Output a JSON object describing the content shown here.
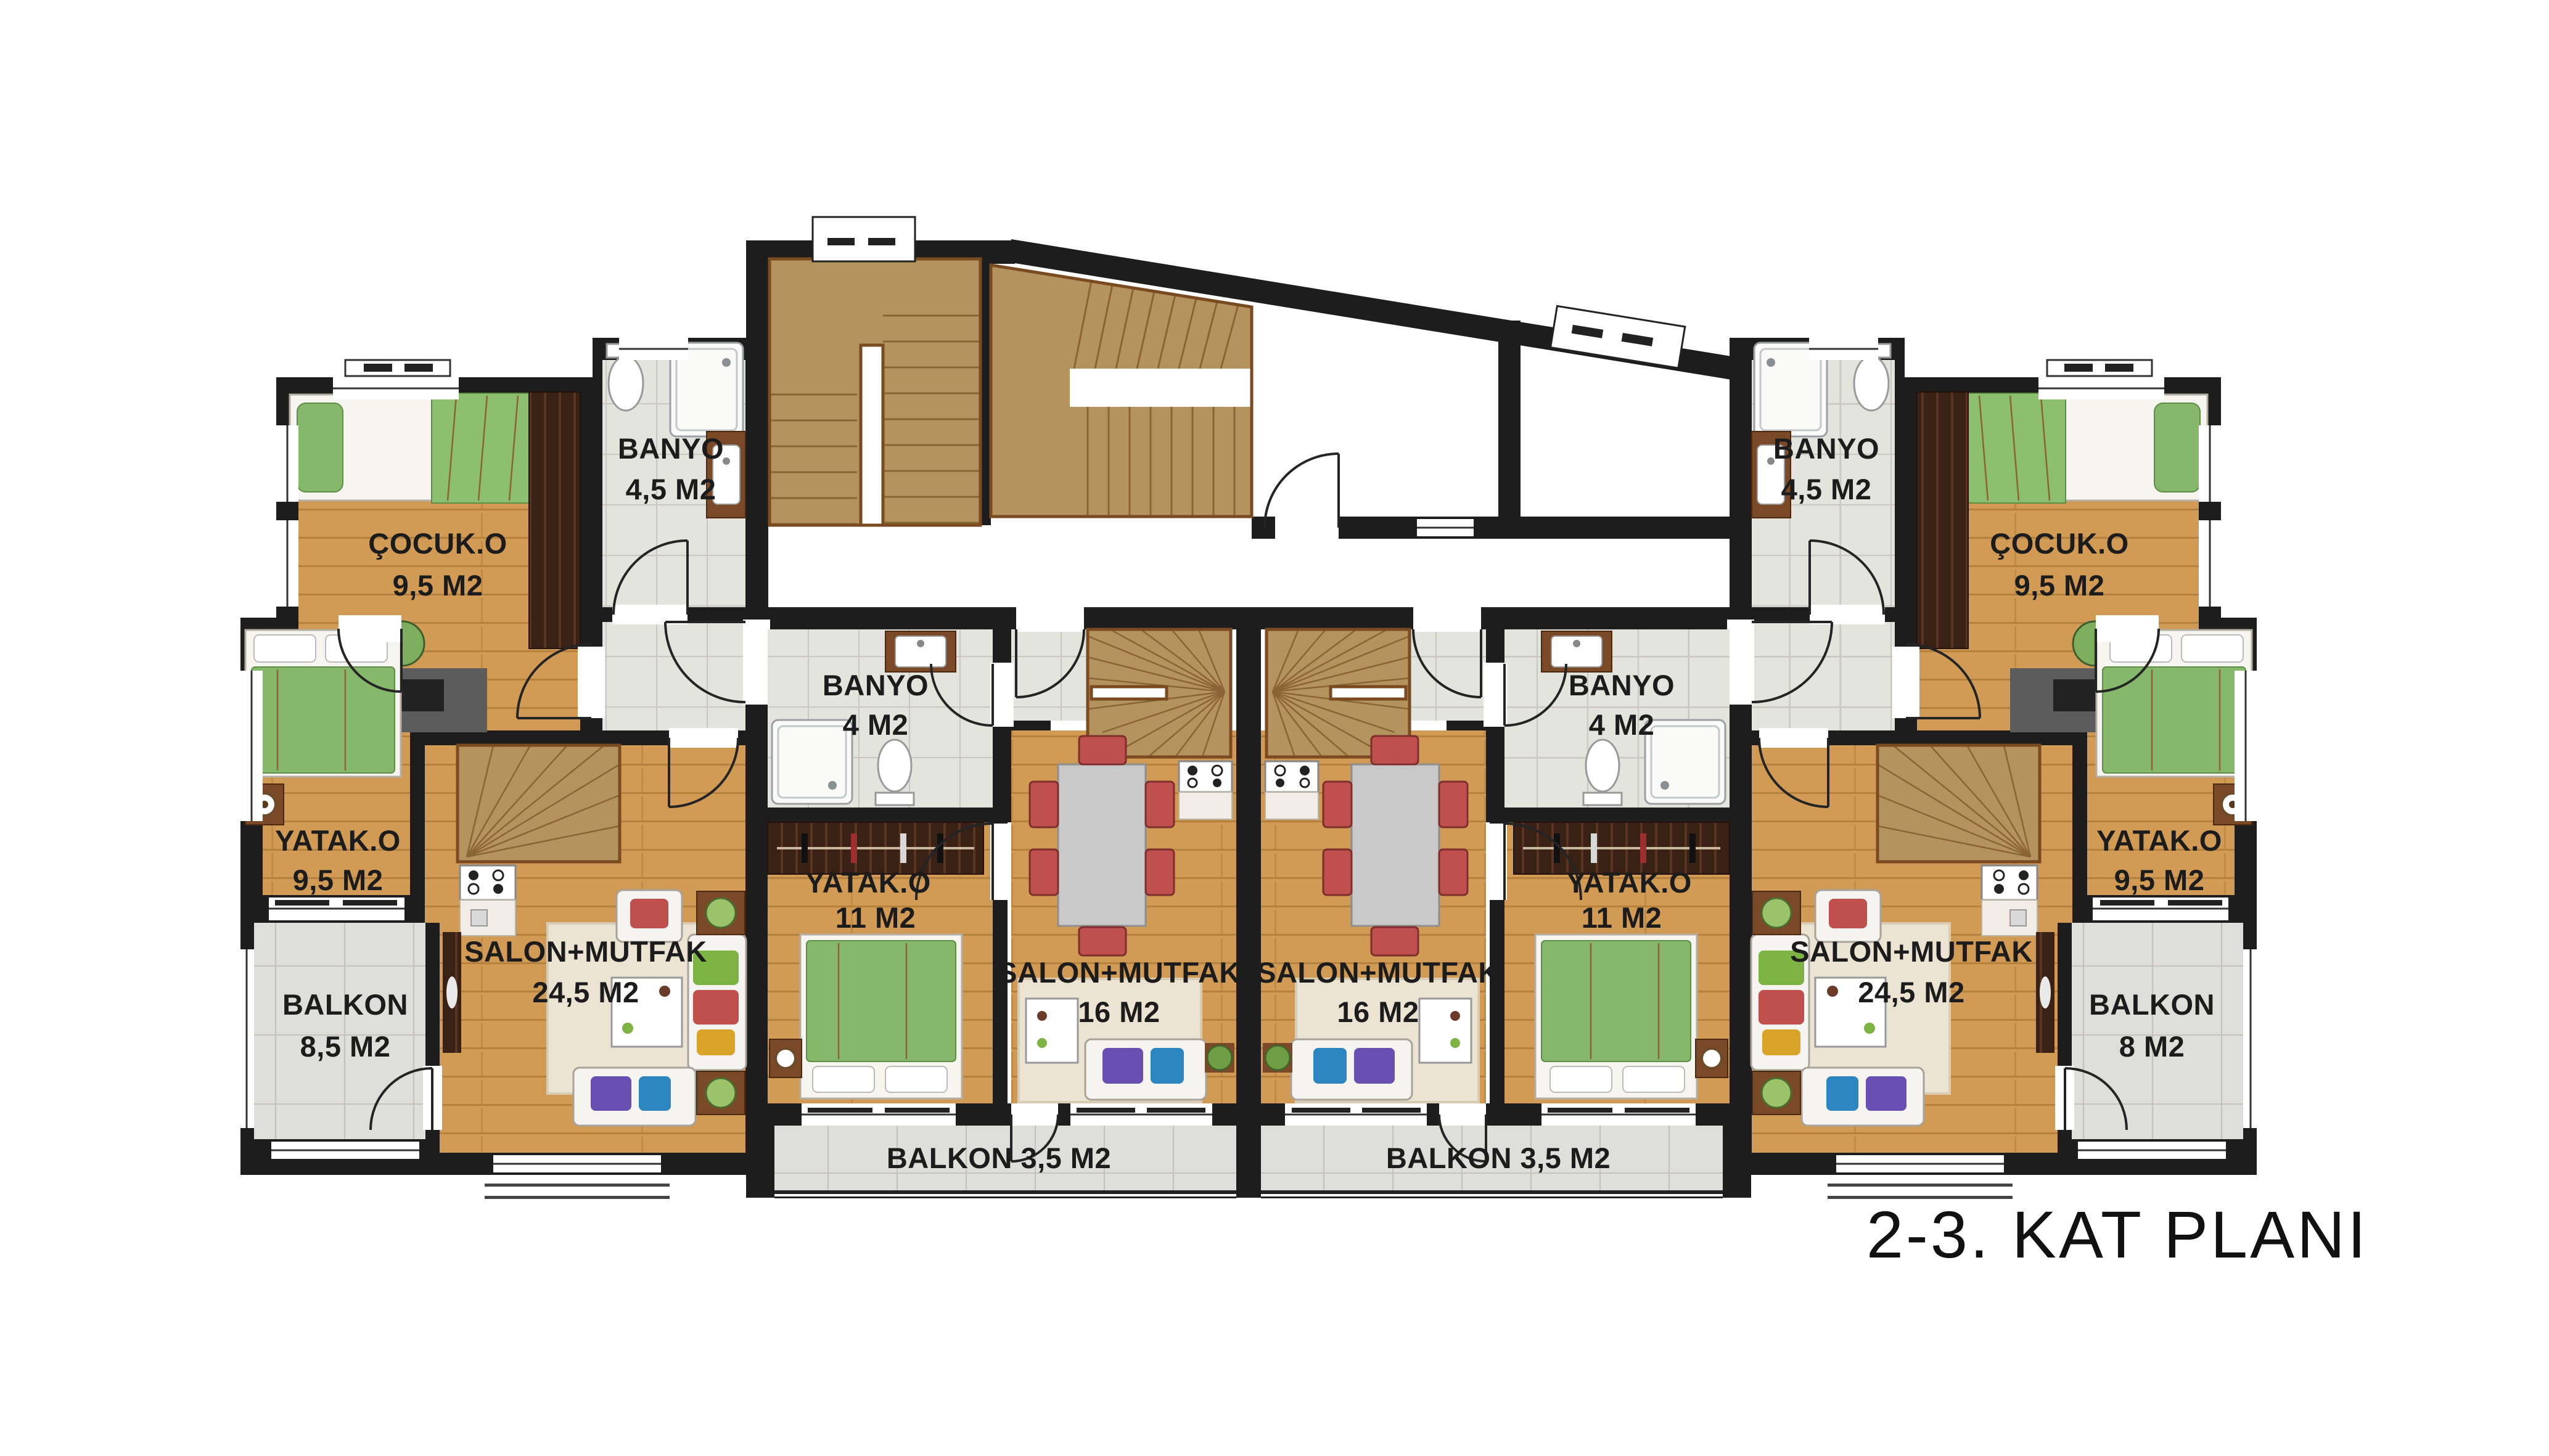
{
  "title": "2-3. KAT PLANI",
  "apartments": {
    "left": {
      "cocuk": {
        "name": "ÇOCUK.O",
        "area": "9,5 M2"
      },
      "banyo": {
        "name": "BANYO",
        "area": "4,5 M2"
      },
      "yatak": {
        "name": "YATAK.O",
        "area": "9,5 M2"
      },
      "balkon": {
        "name": "BALKON",
        "area": "8,5 M2"
      },
      "salon": {
        "name": "SALON+MUTFAK",
        "area": "24,5 M2"
      }
    },
    "center_left": {
      "banyo": {
        "name": "BANYO",
        "area": "4 M2"
      },
      "yatak": {
        "name": "YATAK.O",
        "area": "11 M2"
      },
      "salon": {
        "name": "SALON+MUTFAK",
        "area": "16 M2"
      },
      "balkon": {
        "name": "BALKON 3,5 M2"
      }
    },
    "center_right": {
      "banyo": {
        "name": "BANYO",
        "area": "4 M2"
      },
      "yatak": {
        "name": "YATAK.O",
        "area": "11 M2"
      },
      "salon": {
        "name": "SALON+MUTFAK",
        "area": "16 M2"
      },
      "balkon": {
        "name": "BALKON 3,5 M2"
      }
    },
    "right": {
      "cocuk": {
        "name": "ÇOCUK.O",
        "area": "9,5 M2"
      },
      "banyo": {
        "name": "BANYO",
        "area": "4,5 M2"
      },
      "yatak": {
        "name": "YATAK.O",
        "area": "9,5 M2"
      },
      "balkon": {
        "name": "BALKON",
        "area": "8 M2"
      },
      "salon": {
        "name": "SALON+MUTFAK",
        "area": "24,5 M2"
      }
    }
  },
  "colors": {
    "wall": "#1d1d1d",
    "wood_floor": "#d19a55",
    "dark_wood": "#3a2115",
    "tile": "#e4e4de",
    "stair": "#b4935e",
    "bed_green": "#86b86b",
    "chair_red": "#c0504d",
    "pillow_purple": "#6a4fb3",
    "pillow_blue": "#2e86c1",
    "rug": "#ece4d2"
  }
}
